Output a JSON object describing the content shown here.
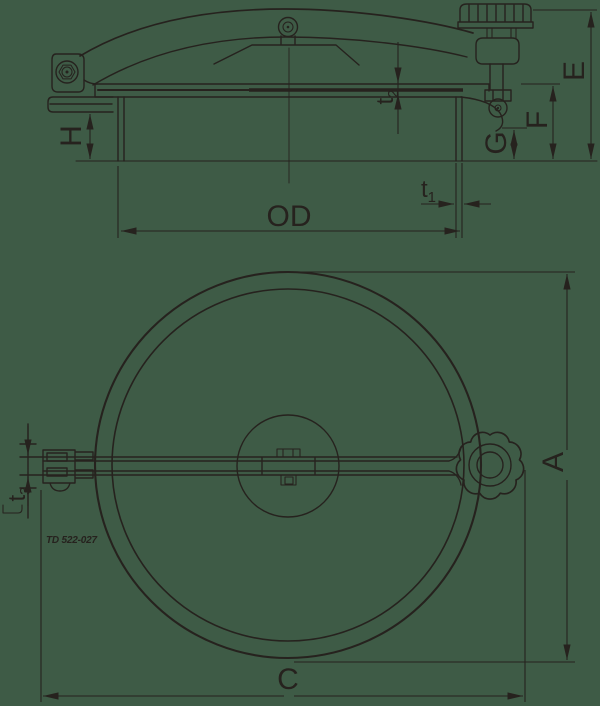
{
  "colors": {
    "background": "#3e5b46",
    "ink": "#26221e"
  },
  "side_view": {
    "labels": {
      "od": "OD",
      "e": "E",
      "f": "F",
      "g": "G",
      "h": "H",
      "t1": {
        "base": "t",
        "sub": "1"
      },
      "t2": {
        "base": "t",
        "sub": "2"
      }
    }
  },
  "plan_view": {
    "labels": {
      "a": "A",
      "c": "C",
      "t3": {
        "base": "t",
        "sub": "3"
      }
    },
    "part_note": "TD 522-027"
  }
}
